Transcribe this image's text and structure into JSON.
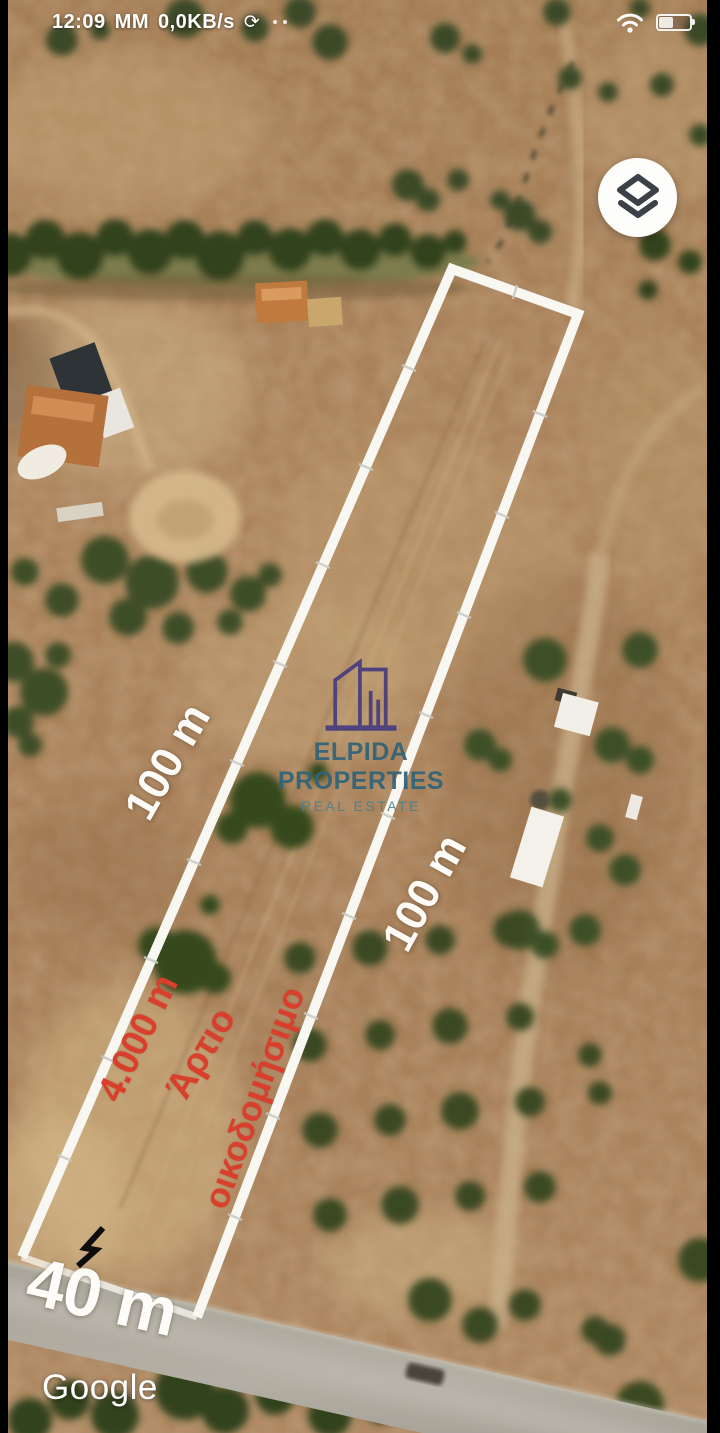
{
  "status_bar": {
    "time": "12:09",
    "carrier": "MM",
    "net_speed": "0,0KB/s",
    "sync_glyph": "⟳"
  },
  "annotations": {
    "side_left_length": "100 m",
    "side_right_length": "100 m",
    "road_frontage": "40 m",
    "area": "4.000 m",
    "zoning_word1": "Άρτιο",
    "zoning_word2": "οικοδομήσιμο",
    "annotation_red": "#d8402d",
    "annotation_white": "#fdfcf8",
    "parcel_line_color": "#f8f7f2"
  },
  "watermark": {
    "brand": "ELPIDA PROPERTIES",
    "tagline": "REAL ESTATE",
    "brand_teal": "#2f6379",
    "logo_purple": "#463c7f"
  },
  "map": {
    "attribution": "Google"
  }
}
